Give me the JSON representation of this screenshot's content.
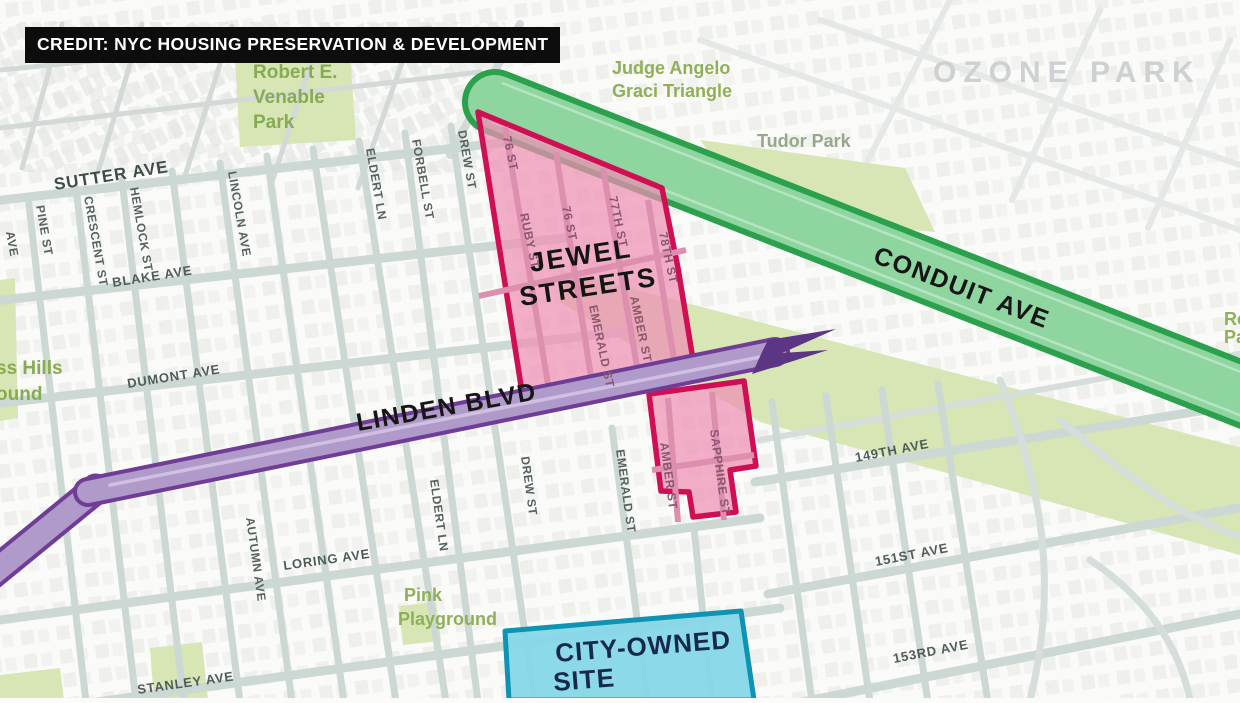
{
  "credit": {
    "text": "CREDIT: NYC HOUSING PRESERVATION & DEVELOPMENT"
  },
  "district_label": "OZONE PARK",
  "highlights": {
    "conduit": "CONDUIT AVE",
    "linden": "LINDEN BLVD",
    "jewel_line1": "JEWEL",
    "jewel_line2": "STREETS",
    "city_line1": "CITY-OWNED",
    "city_line2": "SITE"
  },
  "parks": {
    "venable": [
      "Robert E.",
      "Venable",
      "Park"
    ],
    "graci": [
      "Judge Angelo",
      "Graci Triangle"
    ],
    "tudor": "Tudor Park",
    "pink_playground": [
      "Pink",
      "Playground"
    ],
    "cypress_cut": [
      "ss Hills",
      "ound"
    ],
    "right_edge_cut": [
      "Ro",
      "Pa"
    ]
  },
  "streets": {
    "sutter": "SUTTER AVE",
    "pine": "PINE ST",
    "crescent": "CRESCENT ST",
    "hemlock": "HEMLOCK ST",
    "lincoln": "LINCOLN AVE",
    "blake": "BLAKE AVE",
    "dumont": "DUMONT AVE",
    "eldert_n": "ELDERT LN",
    "forbell": "FORBELL ST",
    "drew_n": "DREW ST",
    "st76_a": "76 ST",
    "ruby": "RUBY ST",
    "st76_b": "76 ST",
    "st77": "77TH ST",
    "st78": "78TH ST",
    "emerald_n": "EMERALD ST",
    "amber_n": "AMBER ST",
    "emerald_s": "EMERALD ST",
    "amber_s": "AMBER ST",
    "sapphire": "SAPPHIRE ST",
    "drew_s": "DREW ST",
    "eldert_s": "ELDERT LN",
    "autumn": "AUTUMN AVE",
    "loring": "LORING AVE",
    "stanley": "STANLEY AVE",
    "ave149": "149TH AVE",
    "ave151": "151ST AVE",
    "ave153": "153RD AVE",
    "left_edge_cut": "AVE"
  },
  "colors": {
    "conduit_fill": "#8fd5a0",
    "conduit_border": "#2ba14d",
    "linden_fill": "#b09ac9",
    "linden_border": "#6f3d96",
    "jewel_fill": "#ee8fb4",
    "jewel_border": "#cf0e53",
    "city_fill": "#86d8e8",
    "city_border": "#0e93b3",
    "park_green": "#d7e6b4",
    "street_gray": "#ccd8d4"
  }
}
